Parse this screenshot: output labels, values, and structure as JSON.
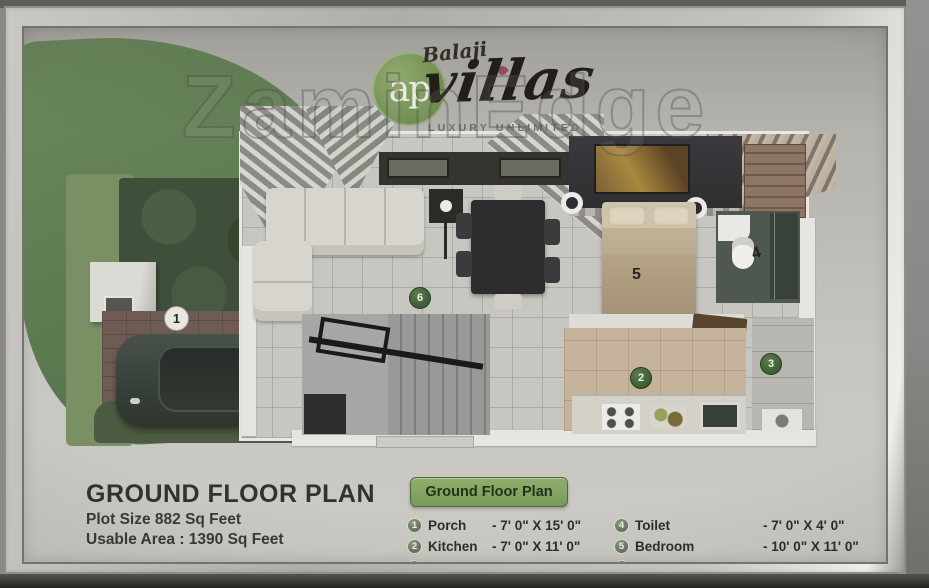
{
  "watermark": "ZaminEdge",
  "logo": {
    "script_name": "Balaji",
    "monogram": "ap",
    "brand": "villas",
    "tagline": "LUXURY UNLIMITED"
  },
  "info": {
    "title": "GROUND FLOOR PLAN",
    "plot_size": "Plot Size 882 Sq Feet",
    "usable_area": "Usable Area : 1390 Sq Feet"
  },
  "legend": {
    "button_label": "Ground Floor Plan",
    "items": [
      {
        "num": "1",
        "name": "Porch",
        "dim": "- 7' 0\" X 15' 0\""
      },
      {
        "num": "2",
        "name": "Kitchen",
        "dim": "- 7' 0\" X 11' 0\""
      },
      {
        "num": "3",
        "name": "Wash",
        "dim": "- 10' 0\" X 4' 0\""
      },
      {
        "num": "4",
        "name": "Toilet",
        "dim": "- 7' 0\" X 4' 0\""
      },
      {
        "num": "5",
        "name": "Bedroom",
        "dim": "- 10' 0\" X 11' 0\""
      },
      {
        "num": "6",
        "name": "Drawing & Dining",
        "dim": "- 10' 4\" X 19' 8\""
      }
    ]
  },
  "plan": {
    "markers": {
      "porch": "1",
      "kitchen": "2",
      "wash": "3",
      "toilet": "4",
      "bedroom": "5",
      "drawing_dining": "6"
    }
  },
  "colors": {
    "accent_green": "#6d8a5e",
    "button_green": "#84a463",
    "legend_circle": "#5d6f55",
    "frame_silver": "#c9c8c4"
  }
}
